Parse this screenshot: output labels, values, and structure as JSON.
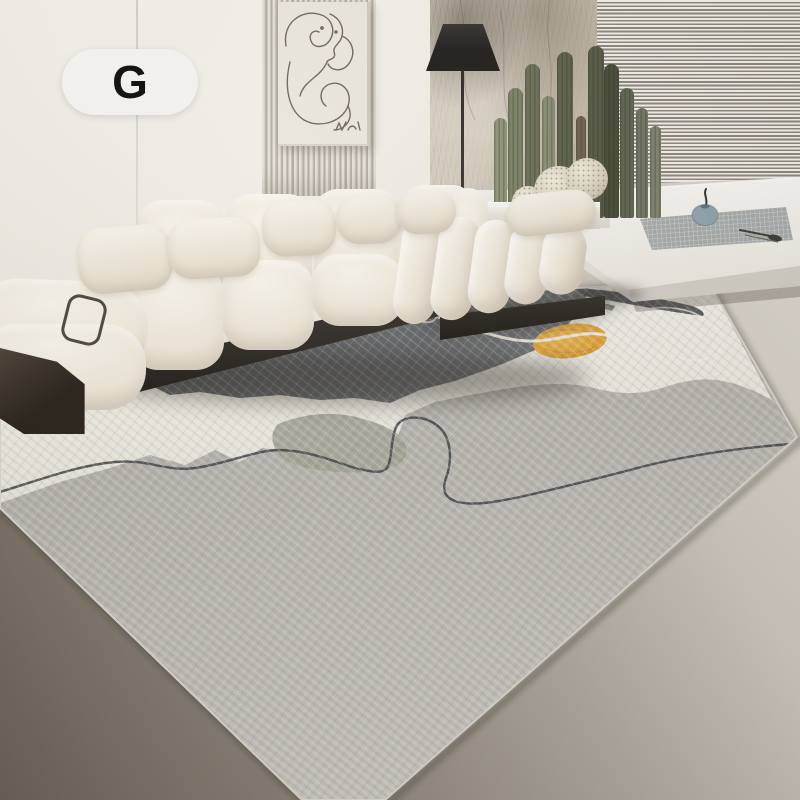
{
  "image_type": "product-lifestyle-photo",
  "badge": {
    "label": "G"
  },
  "palette": {
    "badge-bg": "#f1f0ed",
    "wall": "#f3f0ea",
    "art-canvas": "#eae6de",
    "art-line": "#6e675f",
    "lamp-black": "#1f1d1a",
    "texture-base": "#d4cdc0",
    "blind-light": "#f4f1ec",
    "blind-dark": "#8b857b",
    "cactus-dried": "#6f6150",
    "ball-cactus": "#f0ebdd",
    "floor-dark": "#675f55",
    "floor-mid": "#948c81",
    "floor-light": "#dcd7ce",
    "sofa-light": "#f6f2e9",
    "sofa-mid": "#ece5d7",
    "sofa-shadow": "#dad2c1",
    "sofa-base": "#1c1915",
    "wood-block": "#251f18",
    "metal-handle": "#4a453d",
    "rug-field": "#b6b3ae",
    "rug-white": "#f2efe7",
    "rug-dark": "#5d6064",
    "rug-olive": "#a3a396",
    "rug-orange": "#e5a434",
    "rug-line": "#3e4145",
    "platform-top": "#f8f6f2",
    "mat": "#a6aaa9",
    "vase": "#8fa3ae"
  },
  "scene": {
    "objects": [
      "variant-badge",
      "wall",
      "wall-seam",
      "slat-panel",
      "line-art-frame",
      "floor-lamp",
      "textured-feature-wall",
      "window-blinds",
      "cactus-plants",
      "ball-cactus",
      "planter",
      "window-bench-platform",
      "bench-mat",
      "bud-vase",
      "serving-utensil",
      "modular-sofa",
      "throw-pillows",
      "metal-handle",
      "wood-side-block",
      "area-rug",
      "rug-white-band",
      "rug-dark-patch",
      "rug-orange-circle",
      "rug-line-motif",
      "floor"
    ]
  }
}
